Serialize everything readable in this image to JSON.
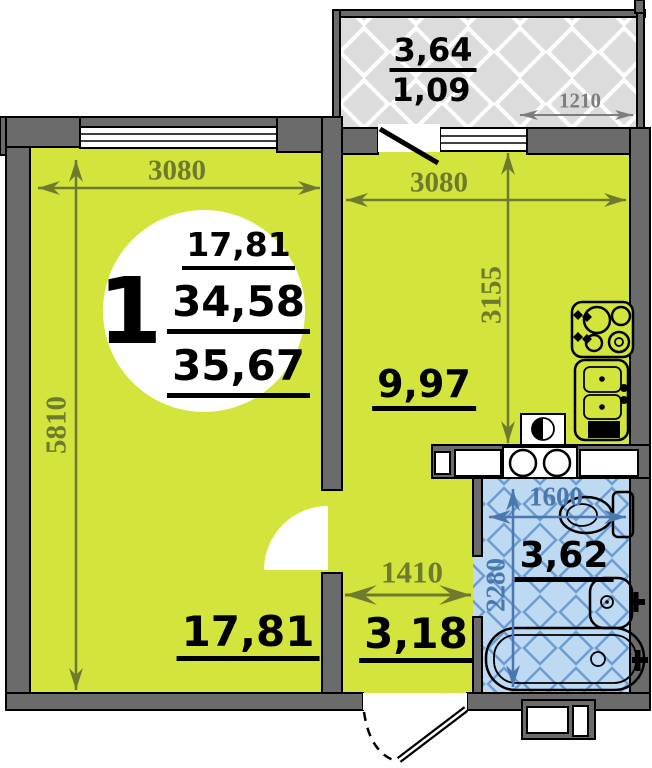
{
  "badge": {
    "unit": "1",
    "living_area": "17,81",
    "total_area": "34,58",
    "overall_area": "35,67"
  },
  "rooms": {
    "living": {
      "area": "17,81",
      "dim_width": "3080",
      "dim_height": "5810"
    },
    "kitchen": {
      "area": "9,97",
      "dim_width": "3080",
      "dim_height": "3155"
    },
    "hallway": {
      "area": "3,18",
      "dim_width": "1410"
    },
    "bathroom": {
      "area": "3,62",
      "dim_width": "1600",
      "dim_height": "2280"
    },
    "balcony": {
      "area_total": "3,64",
      "area_coef": "1,09",
      "dim_width": "1210"
    }
  },
  "colors": {
    "room": "#d3e53c",
    "wall": "#6b6b6b",
    "dim": "#6e7b2e",
    "dimgray": "#7d7d7d",
    "dimblue": "#4a77ad",
    "bath-bg": "#bed9f2",
    "bath-line": "#6c9cd1",
    "balcony-bg": "#dcdcdc",
    "balcony-line": "#ffffff"
  }
}
